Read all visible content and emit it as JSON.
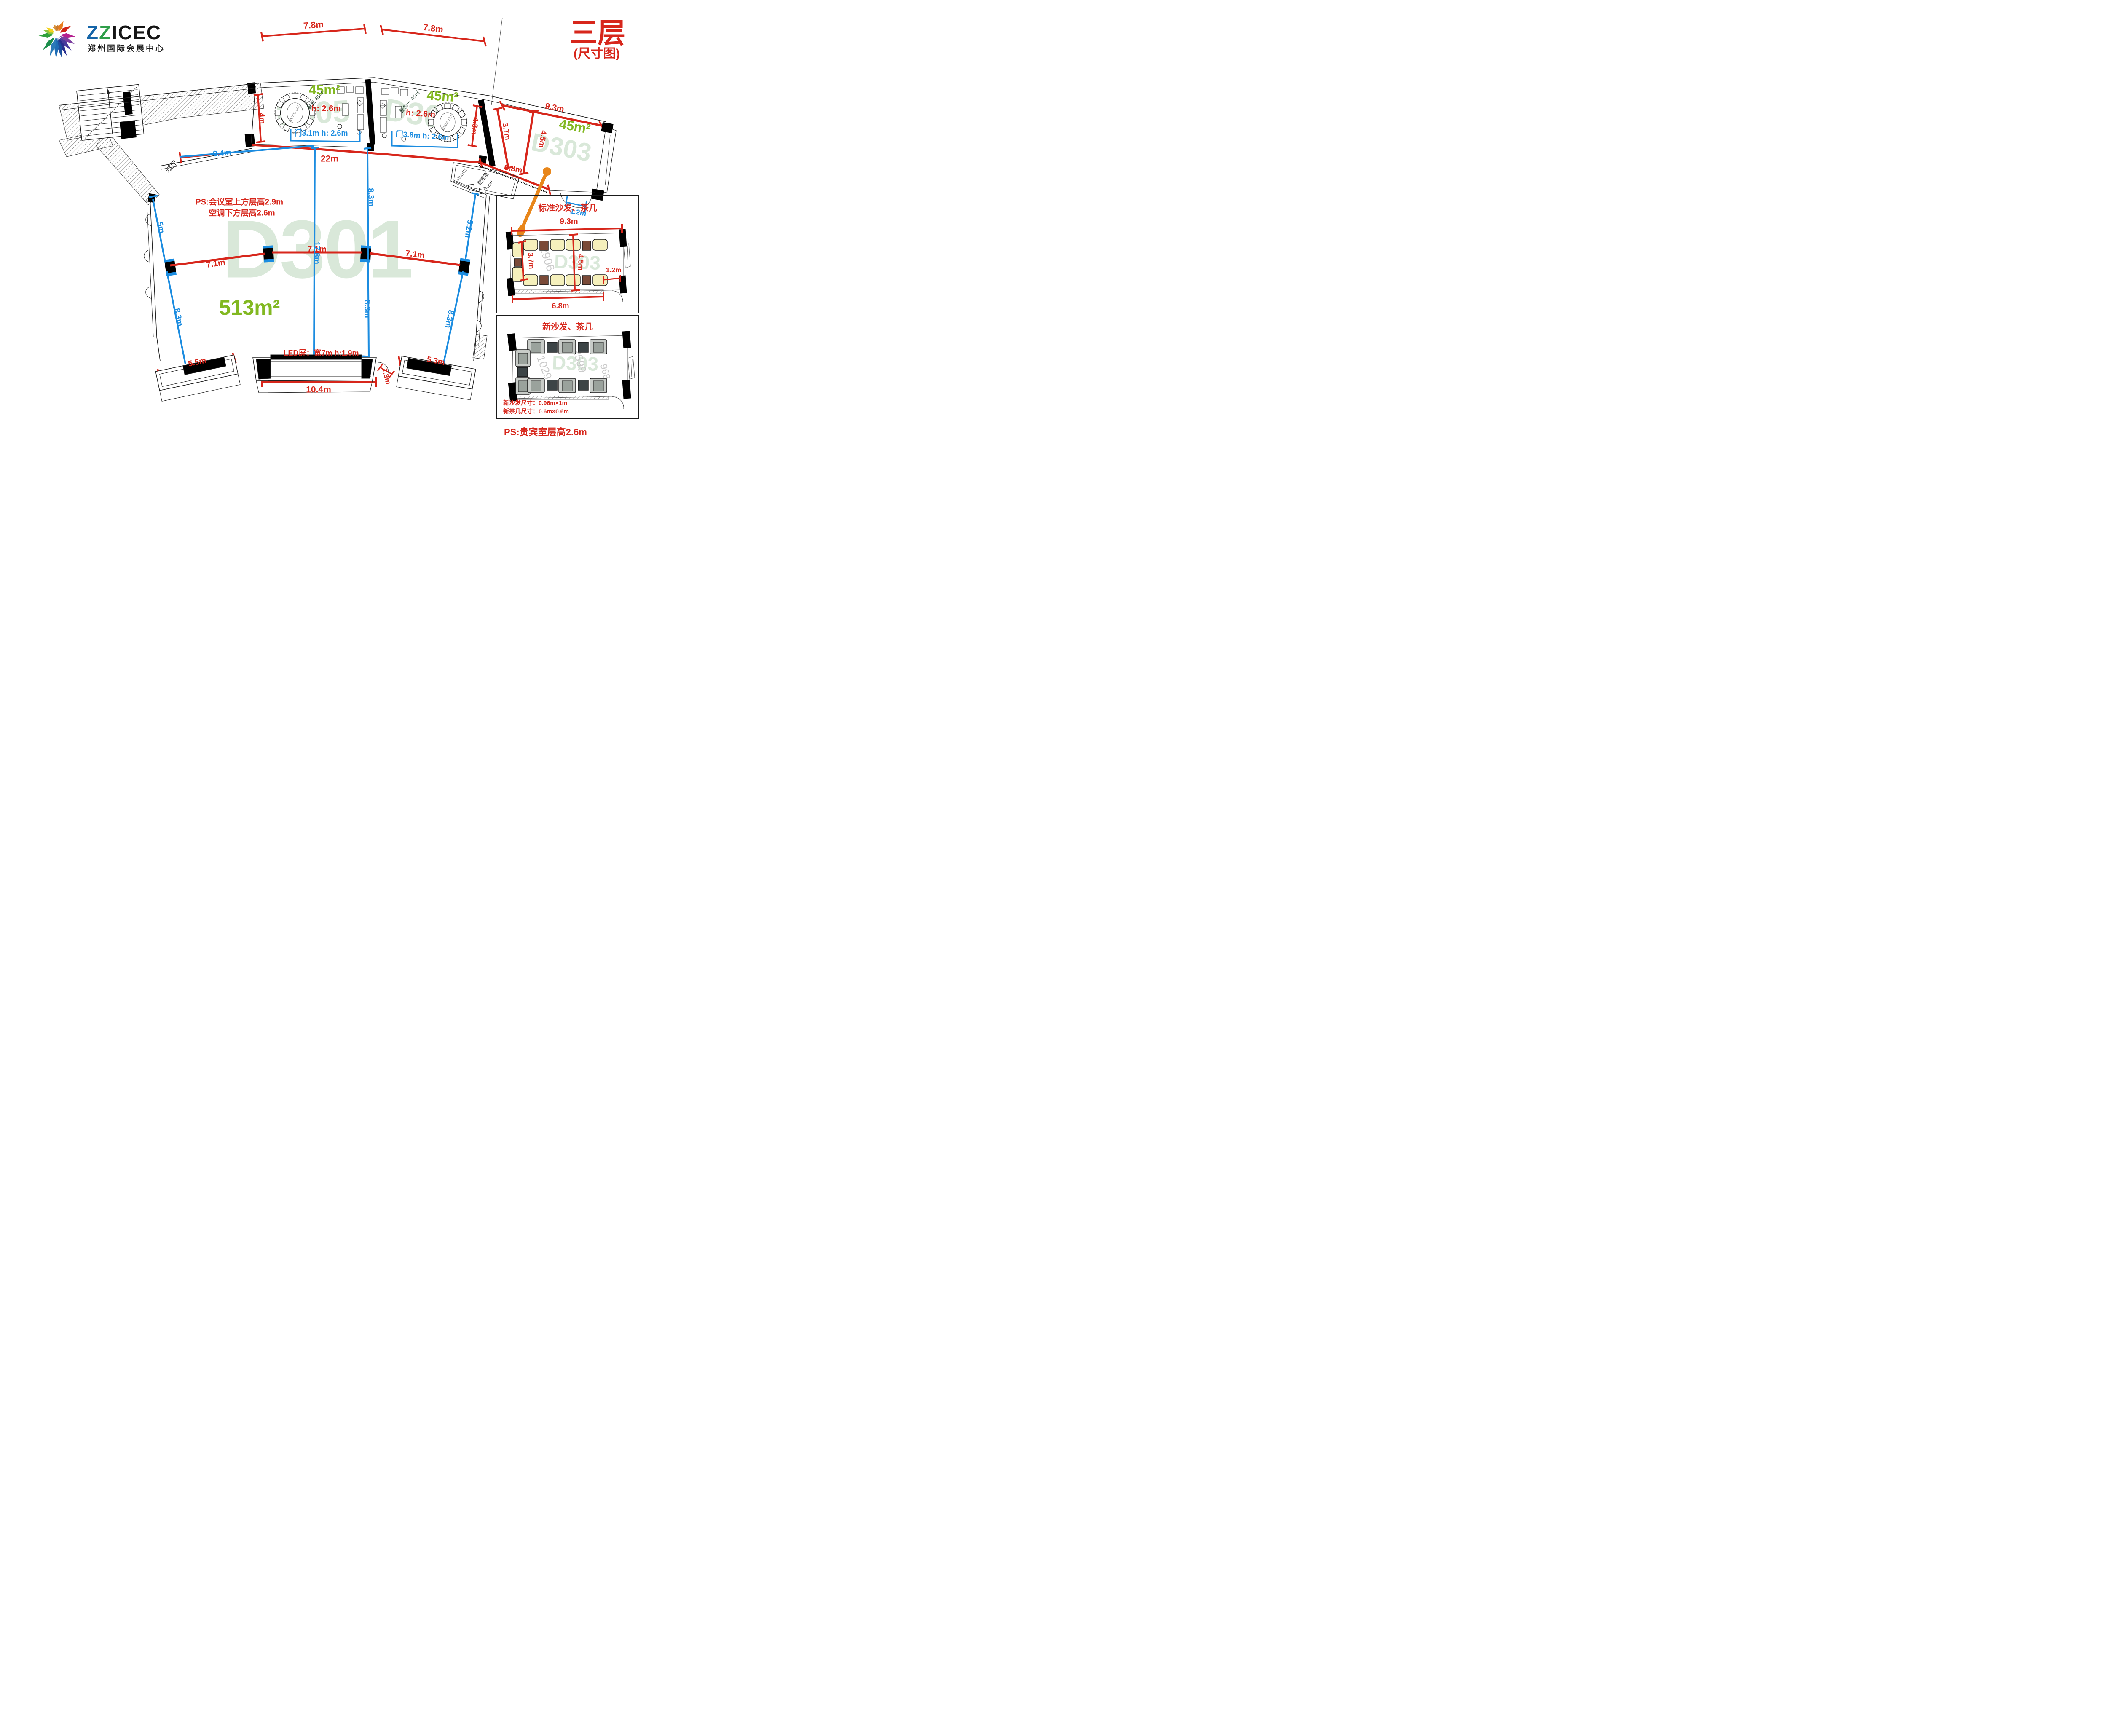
{
  "header": {
    "brand_z1": "Z",
    "brand_z2": "Z",
    "brand_icec": "ICEC",
    "brand_subtitle": "郑州国际会展中心",
    "floor_title": "三层",
    "floor_subtitle": "(尺寸图)"
  },
  "colors": {
    "dim_red": "#d7261b",
    "dim_blue": "#1b8ce0",
    "area_green": "#82b821",
    "watermark_green": "#d9e8d9",
    "callout_orange": "#e8861a"
  },
  "hall": {
    "watermark": "D301",
    "area": "513m²",
    "ps_line1": "PS:会议室上方层高2.9m",
    "ps_line2": "空调下方层高2.6m",
    "led_label": "LED屏：宽7m h:1.9m",
    "corridor_label": "过厅",
    "sound_room_code": "3ALDG1",
    "sound_room_name": "音控室",
    "sound_room_area": "16.8㎡"
  },
  "rooms": {
    "dining_left": {
      "watermark": "D305",
      "area": "45m²",
      "height": "h: 2.6m",
      "hand_label": "餐包 45㎡",
      "door_label": "门3.1m h: 2.6m",
      "table_label": "Ø2100 12人"
    },
    "dining_right": {
      "watermark": "D304",
      "area": "45m²",
      "height": "h: 2.6m",
      "hand_label": "餐包一 45㎡",
      "door_label": "门3.8m h: 2.6m",
      "table_label": "Ø2100 12人"
    },
    "d303": {
      "watermark": "D303",
      "area": "45m²"
    }
  },
  "dims": {
    "dining_left_width": "7.8m",
    "dining_right_width": "7.8m",
    "d303_width": "9.3m",
    "hall_top_width": "22m",
    "dining_left_depth": "4m",
    "dining_right_depth": "4.3m",
    "d303_wall_depth": "3.7m",
    "d303_depth": "4.5m",
    "d303_bottom_width": "6.8m",
    "d303_door_width": "1.2m",
    "pillar_span_1": "7.1m",
    "pillar_span_2": "7.1m",
    "pillar_span_3": "7.1m",
    "entry_arc_width": "9.4m",
    "left_upper": "5m",
    "left_lower": "8.3m",
    "hall_depth": "17.8m",
    "mid_upper": "8.3m",
    "mid_lower": "8.3m",
    "right_upper": "5.2m",
    "right_lower": "8.3m",
    "stage_left_width": "5.5m",
    "stage_center_width": "10.4m",
    "stage_door_width": "1.3m",
    "stage_right_width": "5.3m"
  },
  "panel_standard": {
    "title": "标准沙发、茶几",
    "watermark": "D303",
    "bg_code": "2906",
    "dim_width": "9.3m",
    "dim_left": "3.7m",
    "dim_center": "4.5m",
    "dim_right": "1.2m",
    "dim_bottom": "6.8m"
  },
  "panel_new": {
    "title": "新沙发、茶几",
    "watermark": "D303",
    "bg_codes": [
      "1029",
      "2599",
      "968"
    ],
    "sofa_note": "新沙发尺寸：0.96m×1m",
    "table_note": "新茶几尺寸：0.6m×0.6m"
  },
  "footer_note": "PS:贵宾室层高2.6m"
}
